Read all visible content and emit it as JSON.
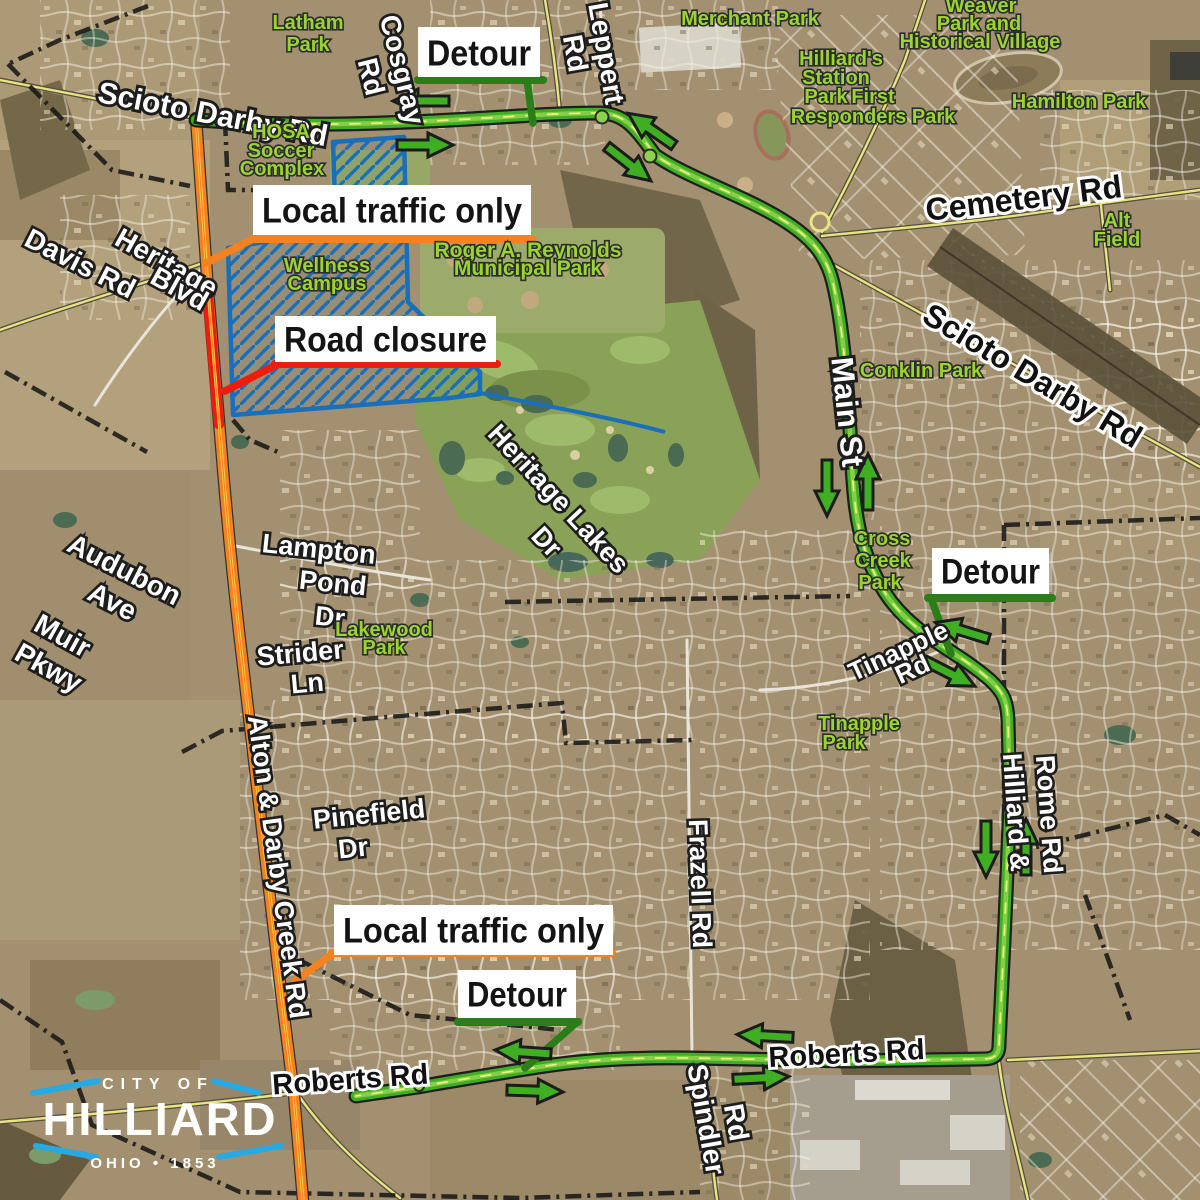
{
  "colors": {
    "detour_route_green": "#3fae23",
    "detour_route_light_green": "#8ed14e",
    "detour_callout_dark_green": "#2a7d18",
    "local_traffic_orange": "#f58220",
    "road_closure_red": "#ee1c0c",
    "construction_zone_blue": "#1a6fba",
    "park_text_green": "#9ad431",
    "logo_blue": "#29a9e1"
  },
  "logo": {
    "city_of": "CITY OF",
    "name": "HILLIARD",
    "tagline": "OHIO • 1853"
  },
  "callouts": [
    {
      "id": "detour-top",
      "text": "Detour",
      "box": [
        418,
        27,
        122,
        50
      ],
      "accent": "#2a7d18",
      "underline": [
        418,
        80,
        543,
        80
      ],
      "leader": "M527,80 L533,123",
      "font": 36
    },
    {
      "id": "local-traffic-top",
      "text": "Local traffic only",
      "box": [
        253,
        185,
        278,
        50
      ],
      "accent": "#f58220",
      "underline": [
        253,
        239,
        533,
        239
      ],
      "leader": "M253,239 L206,263",
      "font": 35
    },
    {
      "id": "road-closure",
      "text": "Road closure",
      "box": [
        275,
        316,
        221,
        46
      ],
      "accent": "#ee1c0c",
      "underline": [
        275,
        364,
        497,
        364
      ],
      "leader": "M278,364 L225,391",
      "font": 35
    },
    {
      "id": "detour-middle",
      "text": "Detour",
      "box": [
        932,
        548,
        117,
        46
      ],
      "accent": "#2a7d18",
      "underline": [
        928,
        598,
        1052,
        598
      ],
      "leader": "M931,598 L951,654",
      "font": 35
    },
    {
      "id": "local-traffic-bottom",
      "text": "Local traffic only",
      "box": [
        334,
        905,
        279,
        50
      ],
      "accent": "#f58220",
      "underline": [
        332,
        953,
        612,
        953
      ],
      "leader": "M334,953 L295,981",
      "font": 35
    },
    {
      "id": "detour-bottom",
      "text": "Detour",
      "box": [
        458,
        970,
        118,
        48
      ],
      "accent": "#2a7d18",
      "underline": [
        458,
        1022,
        578,
        1022
      ],
      "leader": "M576,1023 L525,1068",
      "font": 35
    }
  ],
  "road_labels": [
    {
      "text": "Scioto Darby Rd",
      "x": 211,
      "y": 124,
      "rot": 11,
      "size": 30,
      "theme": "light"
    },
    {
      "text": "Cosgray",
      "x": 393,
      "y": 72,
      "rot": 76,
      "size": 28,
      "theme": "light"
    },
    {
      "text": "Rd",
      "x": 362,
      "y": 79,
      "rot": 76,
      "size": 28,
      "theme": "light"
    },
    {
      "text": "Leppert",
      "x": 597,
      "y": 55,
      "rot": 80,
      "size": 28,
      "theme": "light"
    },
    {
      "text": "Rd",
      "x": 566,
      "y": 55,
      "rot": 80,
      "size": 28,
      "theme": "light"
    },
    {
      "text": "Davis Rd",
      "x": 76,
      "y": 272,
      "rot": 27,
      "size": 28,
      "theme": "light"
    },
    {
      "text": "Heritage",
      "x": 162,
      "y": 271,
      "rot": 29,
      "size": 28,
      "theme": "light"
    },
    {
      "text": "Blvd",
      "x": 175,
      "y": 297,
      "rot": 29,
      "size": 28,
      "theme": "light"
    },
    {
      "text": "Cemetery Rd",
      "x": 1025,
      "y": 209,
      "rot": -7,
      "size": 32,
      "theme": "dark"
    },
    {
      "text": "Scioto Darby Rd",
      "x": 1027,
      "y": 385,
      "rot": 31,
      "size": 32,
      "theme": "dark"
    },
    {
      "text": "Main St",
      "x": 837,
      "y": 413,
      "rot": 84,
      "size": 31,
      "theme": "light"
    },
    {
      "text": "Audubon",
      "x": 120,
      "y": 578,
      "rot": 27,
      "size": 28,
      "theme": "light"
    },
    {
      "text": "Ave",
      "x": 108,
      "y": 610,
      "rot": 27,
      "size": 28,
      "theme": "light"
    },
    {
      "text": "Muir",
      "x": 58,
      "y": 644,
      "rot": 29,
      "size": 28,
      "theme": "light"
    },
    {
      "text": "Pkwy",
      "x": 44,
      "y": 676,
      "rot": 29,
      "size": 28,
      "theme": "light"
    },
    {
      "text": "Lampton",
      "x": 318,
      "y": 558,
      "rot": 6,
      "size": 27,
      "theme": "light"
    },
    {
      "text": "Pond",
      "x": 332,
      "y": 592,
      "rot": 6,
      "size": 27,
      "theme": "light"
    },
    {
      "text": "Dr",
      "x": 329,
      "y": 626,
      "rot": 6,
      "size": 27,
      "theme": "light"
    },
    {
      "text": "Heritage Lakes",
      "x": 552,
      "y": 505,
      "rot": 47,
      "size": 27,
      "theme": "light"
    },
    {
      "text": "Dr",
      "x": 540,
      "y": 548,
      "rot": 47,
      "size": 27,
      "theme": "light"
    },
    {
      "text": "Strider",
      "x": 301,
      "y": 662,
      "rot": -5,
      "size": 27,
      "theme": "light"
    },
    {
      "text": "Ln",
      "x": 308,
      "y": 692,
      "rot": -5,
      "size": 27,
      "theme": "light"
    },
    {
      "text": "Alton & Darby Creek Rd",
      "x": 269,
      "y": 868,
      "rot": 82,
      "size": 27,
      "theme": "light"
    },
    {
      "text": "Pinefield",
      "x": 370,
      "y": 823,
      "rot": -6,
      "size": 27,
      "theme": "light"
    },
    {
      "text": "Dr",
      "x": 354,
      "y": 857,
      "rot": -6,
      "size": 27,
      "theme": "light"
    },
    {
      "text": "Frazell Rd",
      "x": 691,
      "y": 884,
      "rot": 88,
      "size": 27,
      "theme": "light"
    },
    {
      "text": "Roberts Rd",
      "x": 351,
      "y": 1089,
      "rot": -4,
      "size": 29,
      "theme": "dark"
    },
    {
      "text": "Roberts Rd",
      "x": 847,
      "y": 1063,
      "rot": -3,
      "size": 29,
      "theme": "dark"
    },
    {
      "text": "Spindler",
      "x": 697,
      "y": 1121,
      "rot": 80,
      "size": 28,
      "theme": "light"
    },
    {
      "text": "Rd",
      "x": 727,
      "y": 1124,
      "rot": 80,
      "size": 28,
      "theme": "light"
    },
    {
      "text": "Tinapple",
      "x": 902,
      "y": 659,
      "rot": -25,
      "size": 26,
      "theme": "light"
    },
    {
      "text": "Rd",
      "x": 916,
      "y": 677,
      "rot": -25,
      "size": 26,
      "theme": "light"
    },
    {
      "text": "Hilliard &",
      "x": 1007,
      "y": 813,
      "rot": 86,
      "size": 27,
      "theme": "light"
    },
    {
      "text": "Rome Rd",
      "x": 1040,
      "y": 815,
      "rot": 86,
      "size": 27,
      "theme": "light"
    }
  ],
  "park_labels": [
    {
      "text": "Latham",
      "x": 308,
      "y": 29,
      "size": 20
    },
    {
      "text": "Park",
      "x": 308,
      "y": 51,
      "size": 20
    },
    {
      "text": "Merchant Park",
      "x": 750,
      "y": 25,
      "size": 20
    },
    {
      "text": "Weaver",
      "x": 981,
      "y": 12,
      "size": 20
    },
    {
      "text": "Park and",
      "x": 979,
      "y": 30,
      "size": 20
    },
    {
      "text": "Historical Village",
      "x": 980,
      "y": 48,
      "size": 20
    },
    {
      "text": "Hilliard's",
      "x": 841,
      "y": 65,
      "size": 20
    },
    {
      "text": "Station",
      "x": 836,
      "y": 84,
      "size": 20
    },
    {
      "text": "Park",
      "x": 826,
      "y": 103,
      "size": 20
    },
    {
      "text": "First",
      "x": 873,
      "y": 103,
      "size": 20
    },
    {
      "text": "Responders Park",
      "x": 873,
      "y": 123,
      "size": 20
    },
    {
      "text": "Hamilton Park",
      "x": 1079,
      "y": 108,
      "size": 20
    },
    {
      "text": "Alt",
      "x": 1117,
      "y": 227,
      "size": 20
    },
    {
      "text": "Field",
      "x": 1117,
      "y": 246,
      "size": 20
    },
    {
      "text": "HOSA",
      "x": 281,
      "y": 138,
      "size": 20
    },
    {
      "text": "Soccer",
      "x": 281,
      "y": 157,
      "size": 20
    },
    {
      "text": "Complex",
      "x": 282,
      "y": 175,
      "size": 20
    },
    {
      "text": "Wellness",
      "x": 327,
      "y": 272,
      "size": 20
    },
    {
      "text": "Campus",
      "x": 327,
      "y": 290,
      "size": 20
    },
    {
      "text": "Roger A. Reynolds",
      "x": 528,
      "y": 257,
      "size": 21
    },
    {
      "text": "Municipal Park",
      "x": 528,
      "y": 275,
      "size": 21
    },
    {
      "text": "Conklin Park",
      "x": 921,
      "y": 377,
      "size": 20
    },
    {
      "text": "Cross",
      "x": 882,
      "y": 545,
      "size": 20
    },
    {
      "text": "Creek",
      "x": 883,
      "y": 567,
      "size": 20
    },
    {
      "text": "Park",
      "x": 880,
      "y": 589,
      "size": 20
    },
    {
      "text": "Lakewood",
      "x": 384,
      "y": 636,
      "size": 20
    },
    {
      "text": "Park",
      "x": 384,
      "y": 654,
      "size": 20
    },
    {
      "text": "Tinapple",
      "x": 859,
      "y": 730,
      "size": 20
    },
    {
      "text": "Park",
      "x": 844,
      "y": 749,
      "size": 20
    }
  ],
  "arrows": [
    {
      "x": 422,
      "y": 101,
      "a": 180
    },
    {
      "x": 424,
      "y": 145,
      "a": 0
    },
    {
      "x": 652,
      "y": 130,
      "a": -145
    },
    {
      "x": 628,
      "y": 163,
      "a": 38
    },
    {
      "x": 827,
      "y": 487,
      "a": 90
    },
    {
      "x": 868,
      "y": 483,
      "a": -90
    },
    {
      "x": 963,
      "y": 631,
      "a": 197
    },
    {
      "x": 949,
      "y": 673,
      "a": 27
    },
    {
      "x": 986,
      "y": 848,
      "a": 90
    },
    {
      "x": 1026,
      "y": 848,
      "a": -90
    },
    {
      "x": 524,
      "y": 1052,
      "a": 184
    },
    {
      "x": 534,
      "y": 1091,
      "a": 2
    },
    {
      "x": 766,
      "y": 1036,
      "a": 183
    },
    {
      "x": 760,
      "y": 1078,
      "a": -3
    }
  ]
}
